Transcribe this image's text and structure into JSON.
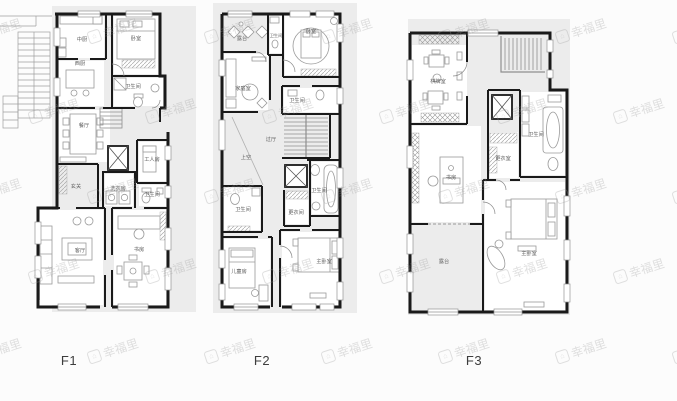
{
  "page": {
    "background": "#fcfcfc"
  },
  "watermark": {
    "text": "幸福里",
    "logo_glyph": "⌂",
    "color": "#9a9a9a"
  },
  "colors": {
    "wall": "#1a1a1a",
    "panel": "#ececec",
    "room_fill": "#ffffff",
    "furniture": "#9a9a9a",
    "label": "#5f5f5f",
    "floor_label": "#3d3d3d"
  },
  "floors": [
    {
      "id": "f1",
      "label": "F1",
      "rooms": [
        {
          "label": "中厨"
        },
        {
          "label": "卧室"
        },
        {
          "label": "西厨"
        },
        {
          "label": "卫生间"
        },
        {
          "label": "餐厅"
        },
        {
          "label": "工人房"
        },
        {
          "label": "玄关"
        },
        {
          "label": "洗衣房"
        },
        {
          "label": "卫生间"
        },
        {
          "label": "客厅"
        },
        {
          "label": "书房"
        }
      ]
    },
    {
      "id": "f2",
      "label": "F2",
      "rooms": [
        {
          "label": "露台"
        },
        {
          "label": "卧室"
        },
        {
          "label": "卫生间"
        },
        {
          "label": "家庭室"
        },
        {
          "label": "卫生间"
        },
        {
          "label": "过厅"
        },
        {
          "label": "上空"
        },
        {
          "label": "卫生间"
        },
        {
          "label": "更衣间"
        },
        {
          "label": "卫生间"
        },
        {
          "label": "儿童房"
        },
        {
          "label": "主卧室"
        }
      ]
    },
    {
      "id": "f3",
      "label": "F3",
      "rooms": [
        {
          "label": "棋牌室"
        },
        {
          "label": "卫生间"
        },
        {
          "label": "更衣室"
        },
        {
          "label": "书房"
        },
        {
          "label": "露台"
        },
        {
          "label": "主卧室"
        }
      ]
    }
  ]
}
